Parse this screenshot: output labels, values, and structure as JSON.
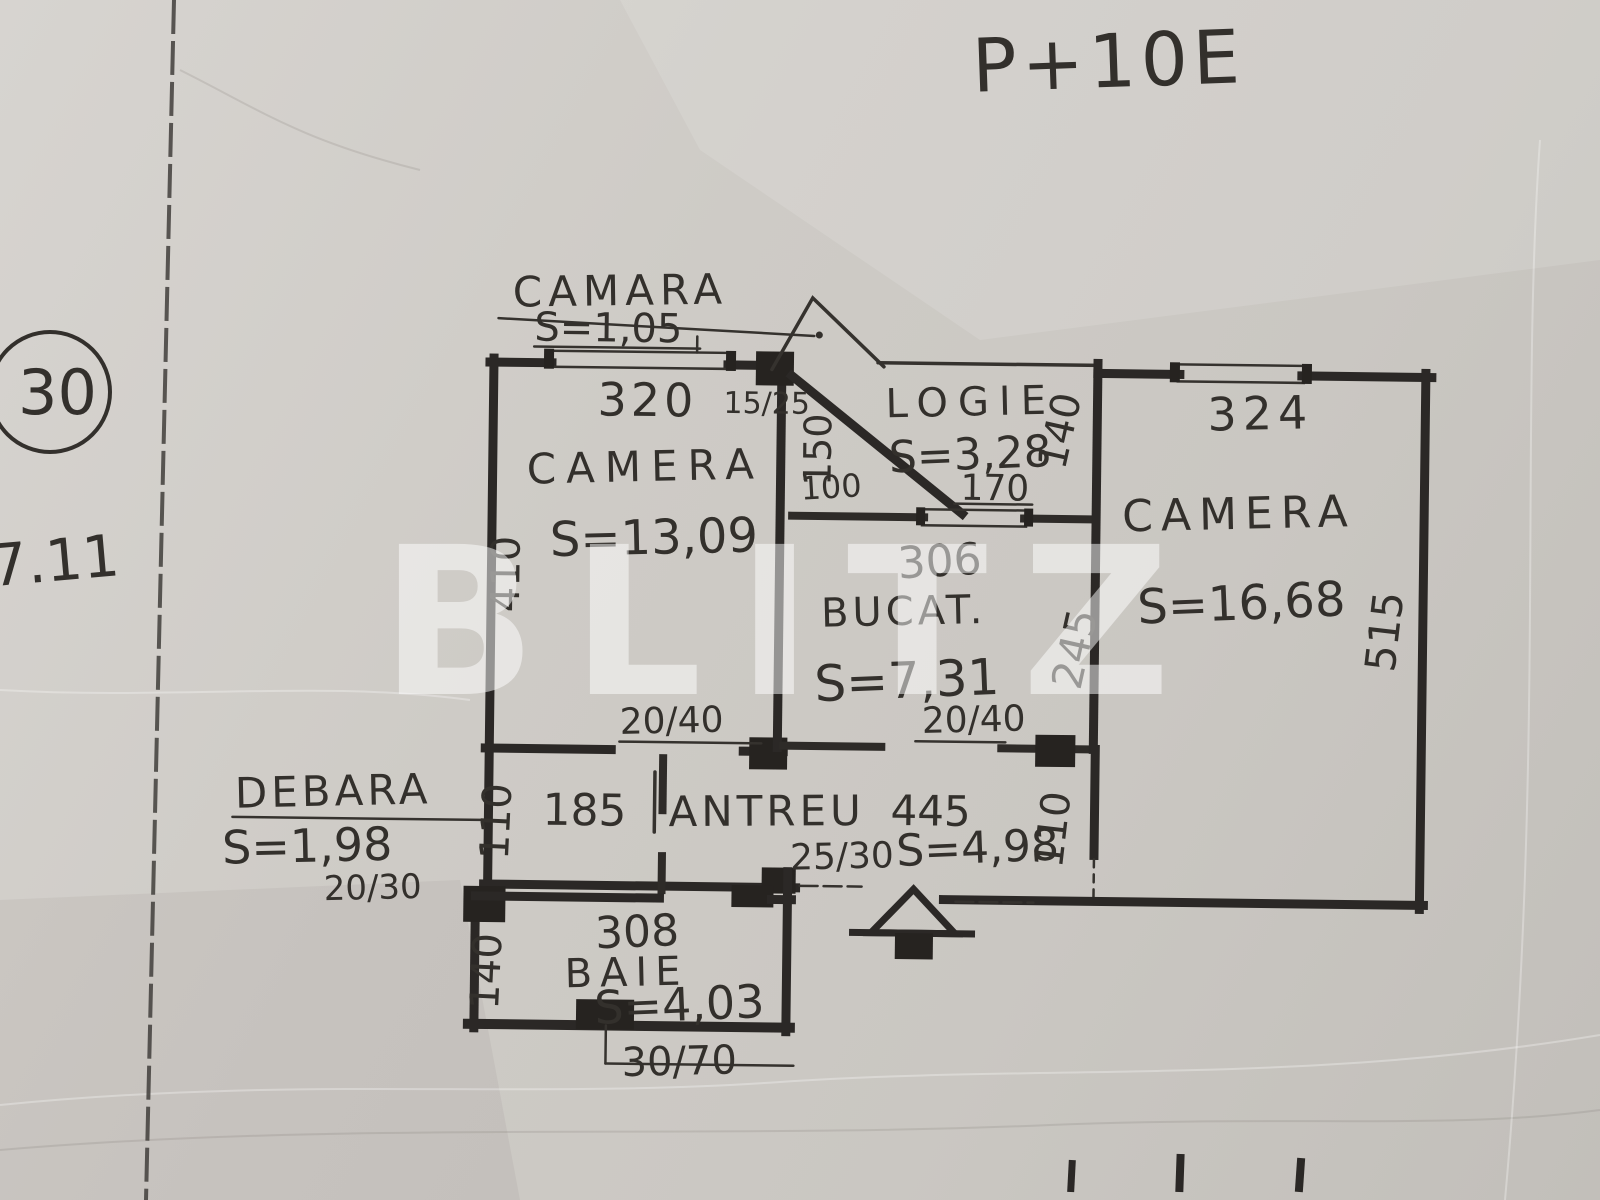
{
  "page": {
    "building_regime": "P+10E",
    "plan_number": "30",
    "sheet_ref": "7.11",
    "watermark": "BLITZ"
  },
  "rooms": {
    "camara": {
      "label": "CAMARA",
      "area": "S=1,05"
    },
    "camera_left": {
      "label": "CAMERA",
      "area": "S=13,09"
    },
    "logie": {
      "label": "LOGIE",
      "area": "S=3,28"
    },
    "bucatarie": {
      "label": "BUCAT.",
      "area": "S=7,31"
    },
    "camera_right": {
      "label": "CAMERA",
      "area": "S=16,68"
    },
    "antreu": {
      "label": "ANTREU",
      "length": "445",
      "area": "S=4,98"
    },
    "debara": {
      "label": "DEBARA",
      "area": "S=1,98"
    },
    "baie": {
      "label": "BAIE",
      "area": "S=4,03"
    }
  },
  "dimensions": {
    "camera_left_width": "320",
    "camera_left_window": "15/25",
    "camera_left_depth": "410",
    "camara_niche_depth": "150",
    "camara_niche_width": "100",
    "logie_window_width": "170",
    "logie_depth": "140",
    "bucatarie_width": "306",
    "bucatarie_depth": "245",
    "camera_right_width": "324",
    "camera_right_depth": "515",
    "camera_left_door": "20/40",
    "bucatarie_door": "20/40",
    "debara_width": "185",
    "debara_door": "20/30",
    "antreu_left_depth": "110",
    "antreu_right_depth": "110",
    "antreu_window": "25/30",
    "baie_width": "308",
    "baie_depth": "140",
    "baie_vent": "30/70"
  }
}
